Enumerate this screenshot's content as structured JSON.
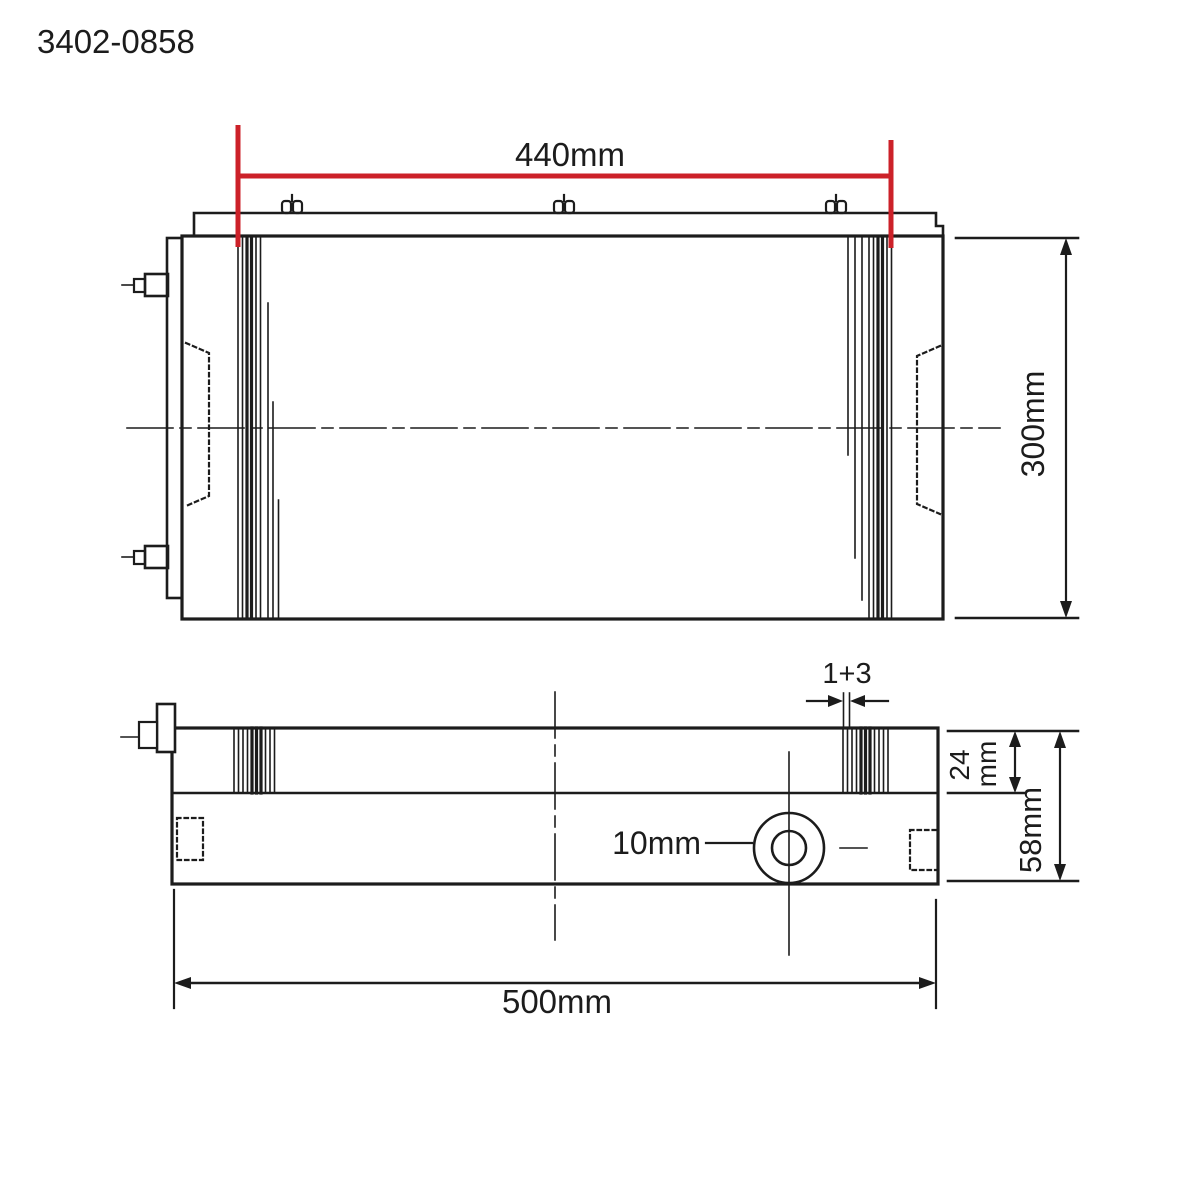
{
  "part_number": "3402-0858",
  "colors": {
    "ink": "#1c1c1c",
    "red": "#cc2129",
    "background": "#ffffff"
  },
  "top_view": {
    "dim_magnet_width": "440mm",
    "dim_height": "300mm"
  },
  "side_view": {
    "dim_pole_pitch": "1+3",
    "dim_pole_depth_value": "24",
    "dim_pole_depth_unit": "mm",
    "dim_total_height": "58mm",
    "dim_hole_diameter": "10mm",
    "dim_total_length": "500mm"
  }
}
